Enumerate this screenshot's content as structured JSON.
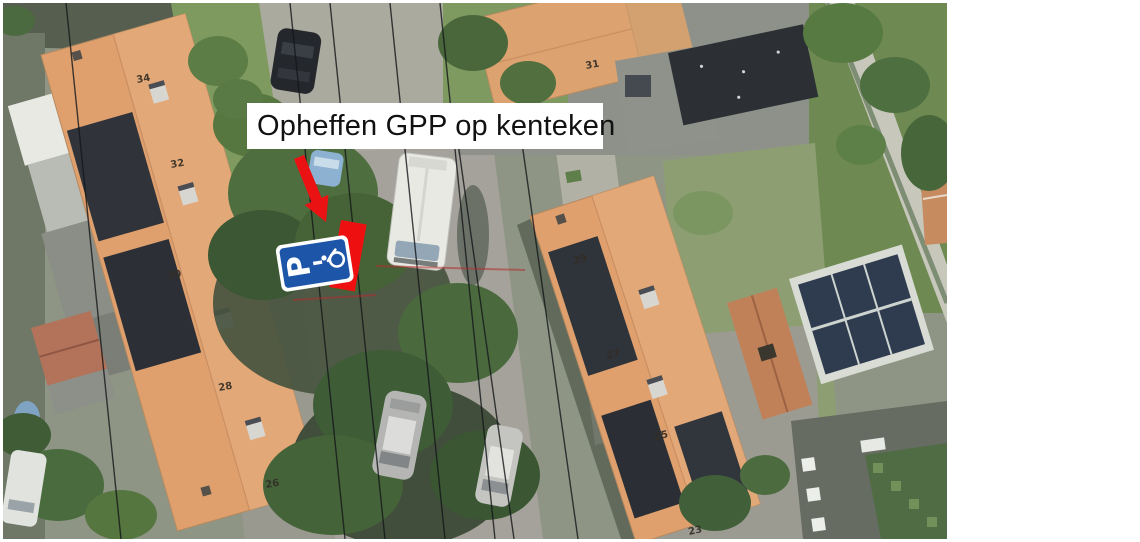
{
  "annotation": {
    "label": "Opheffen GPP op kenteken",
    "arrow_color": "#ea1212",
    "marker_color": "#ee1010"
  },
  "sign": {
    "letter": "P",
    "background": "#1d55a8",
    "icon": "wheelchair-icon"
  },
  "map": {
    "house_numbers": {
      "h34": "34",
      "h32": "32",
      "h30": "30",
      "h28": "28",
      "h26": "26",
      "h31": "31",
      "h29": "29",
      "h27": "27",
      "h25": "25",
      "h23": "23"
    }
  }
}
